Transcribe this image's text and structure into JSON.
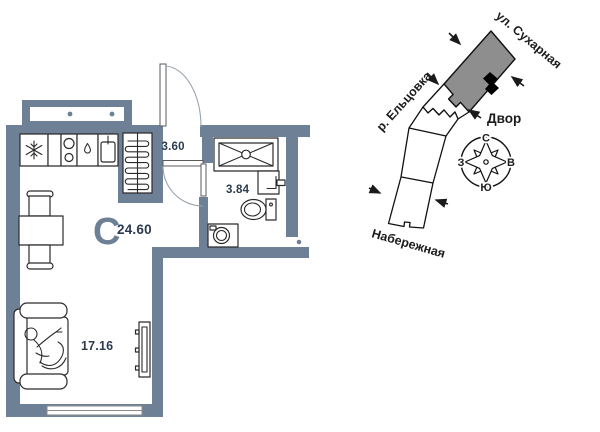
{
  "floor_plan": {
    "type_letter": "C",
    "total_area": "24.60",
    "areas": {
      "hallway": "3.60",
      "bathroom": "3.84",
      "living": "17.16"
    },
    "icons": [
      "fridge-icon",
      "stove-icon",
      "sink-icon",
      "wardrobe-icon",
      "shower-icon",
      "washbasin-icon",
      "toilet-icon",
      "washing-machine-icon",
      "table-icon",
      "chair-icon",
      "sofa-icon",
      "person-icon",
      "tv-icon",
      "window",
      "door-arc"
    ]
  },
  "site_plan": {
    "street_top": "ул. Сухарная",
    "river": "р. Ельцовка",
    "courtyard": "Двор",
    "embankment": "Набережная",
    "compass": {
      "north": "С",
      "south": "Ю",
      "west": "З",
      "east": "В"
    }
  },
  "colors": {
    "wall": "#6E8096",
    "number_text": "#2B3A50",
    "site_text": "#1C1C1C",
    "building_fill": "#8E8E8E",
    "fixture_line": "#2B2B2B",
    "door_arc": "#9AA3AD"
  }
}
